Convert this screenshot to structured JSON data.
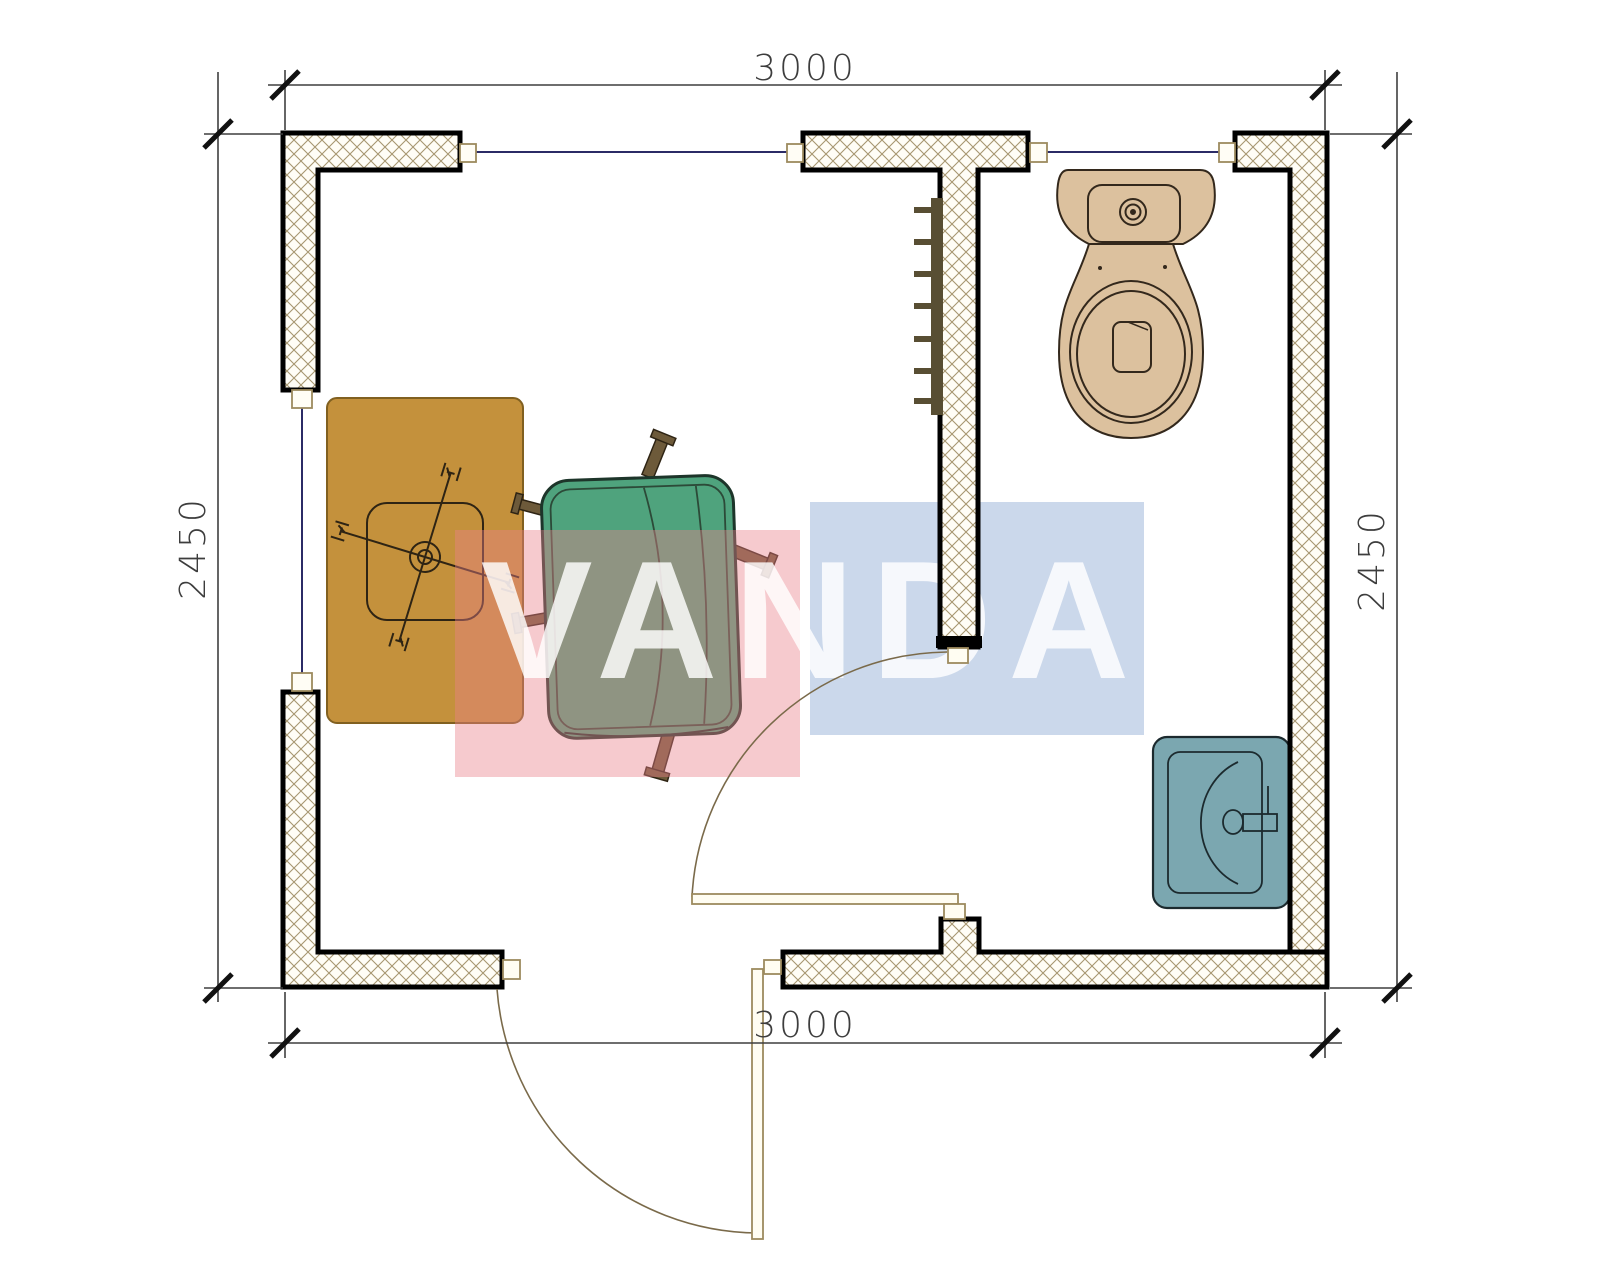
{
  "title": "cabin-floor-plan",
  "dimensions": {
    "top": "3000",
    "bottom": "3000",
    "left": "2450",
    "right": "2450"
  },
  "watermark": {
    "text": "VANDA",
    "red_color": "rgba(233,128,138,0.42)",
    "blue_color": "rgba(140,168,210,0.45)",
    "text_color": "rgba(255,255,255,0.82)"
  },
  "colors": {
    "wall_fill": "#fffdf6",
    "hatch_line": "#a79670",
    "wall_outline": "#000000",
    "desk": "#c4913c",
    "desk_border": "#816020",
    "armchair": "#4fa37d",
    "armchair_leg": "#6d5a3a",
    "toilet": "#dcc19e",
    "sink": "#7ba7b0",
    "radiator": "#584e33",
    "window_line": "#2b2b66",
    "door_line": "#9d8a5e",
    "dimension": "#3d3d3d"
  },
  "fixtures": {
    "desk": "desk",
    "office_chair": "office chair",
    "armchair": "armchair",
    "toilet": "toilet",
    "sink": "sink",
    "radiator": "radiator",
    "interior_door": "interior door",
    "exterior_door": "exterior door"
  }
}
